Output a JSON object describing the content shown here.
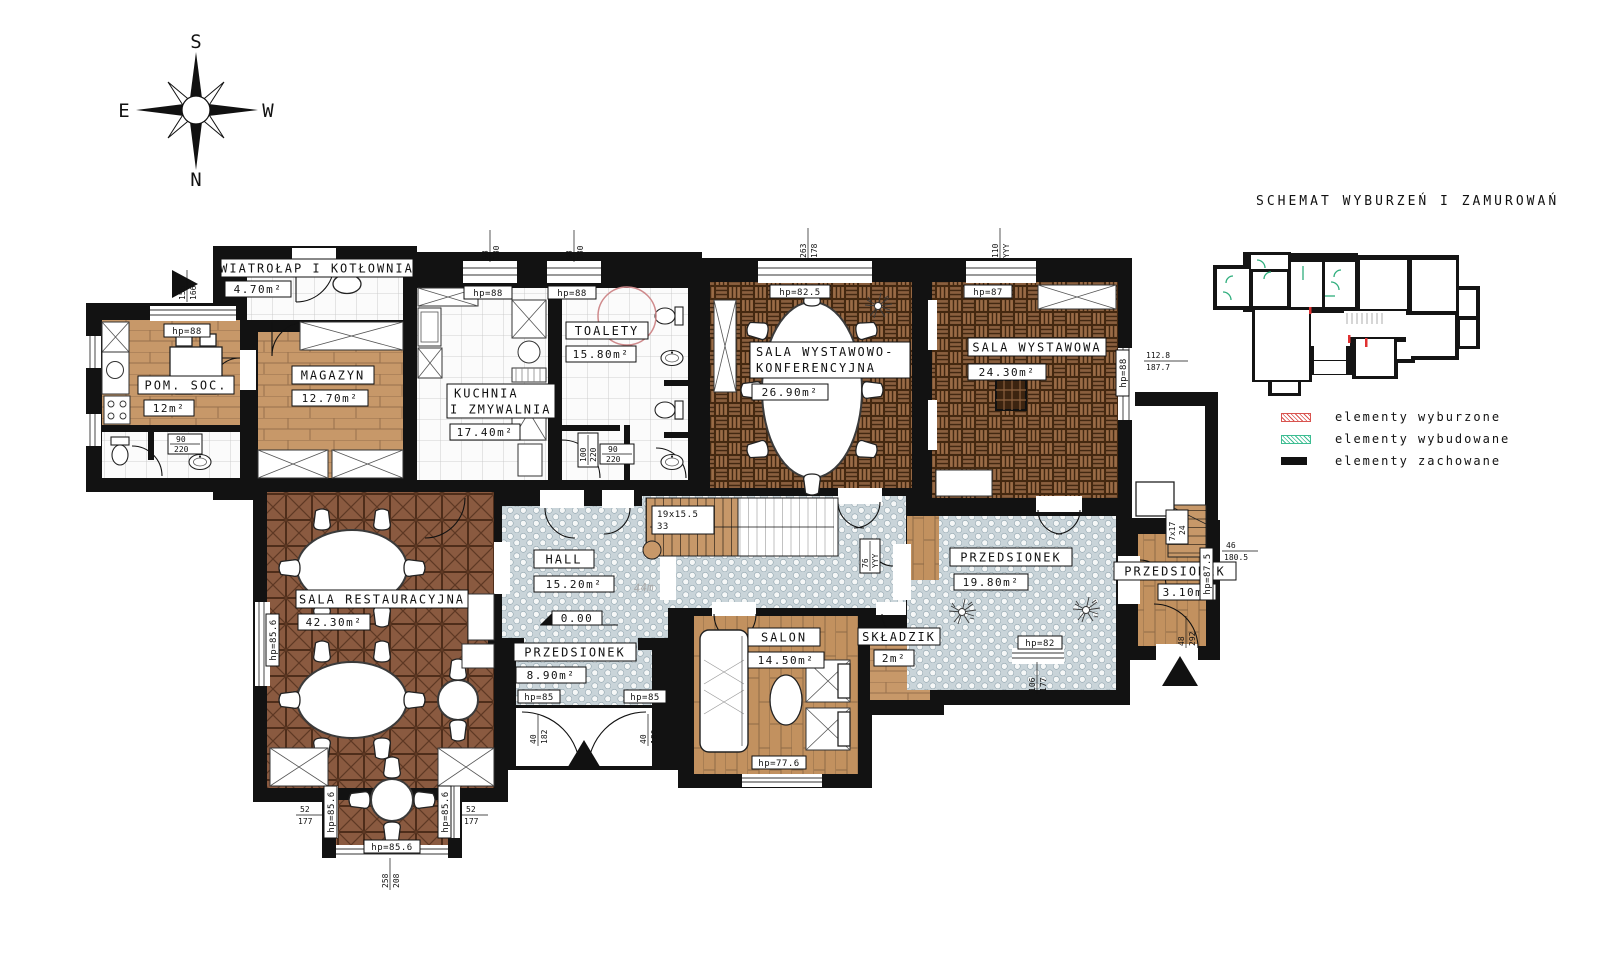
{
  "title": "SCHEMAT WYBURZEŃ I ZAMUROWAŃ",
  "compass": {
    "top": "S",
    "bottom": "N",
    "left": "E",
    "right": "W"
  },
  "legend": [
    {
      "label": "elementy wyburzone",
      "color": "#d9534f",
      "style": "red-hatch"
    },
    {
      "label": "elementy wybudowane",
      "color": "#3dbd92",
      "style": "green-hatch"
    },
    {
      "label": "elementy zachowane",
      "color": "#111111",
      "style": "solid"
    }
  ],
  "colors": {
    "wall": "#121212",
    "wood": "#c79869",
    "parquet_dark": "#8a5a40",
    "mosaic": "#c9d4d9",
    "demolished": "#e03131",
    "built": "#2fae7d"
  },
  "rooms": [
    {
      "line1": "WIATROŁAP I KOTŁOWNIA",
      "area": "4.70m²"
    },
    {
      "line1": "POM. SOC.",
      "area": "12m²"
    },
    {
      "line1": "MAGAZYN",
      "area": "12.70m²"
    },
    {
      "line1": "KUCHNIA",
      "line2": "I ZMYWALNIA",
      "area": "17.40m²"
    },
    {
      "line1": "TOALETY",
      "area": "15.80m²"
    },
    {
      "line1": "SALA WYSTAWOWO-",
      "line2": "KONFERENCYJNA",
      "area": "26.90m²"
    },
    {
      "line1": "SALA WYSTAWOWA",
      "area": "24.30m²"
    },
    {
      "line1": "SALA RESTAURACYJNA",
      "area": "42.30m²"
    },
    {
      "line1": "HALL",
      "area": "15.20m²"
    },
    {
      "line1": "PRZEDSIONEK",
      "area": "8.90m²"
    },
    {
      "line1": "SALON",
      "area": "14.50m²"
    },
    {
      "line1": "SKŁADZIK",
      "area": "2m²"
    },
    {
      "line1": "PRZEDSIONEK",
      "area": "19.80m²"
    },
    {
      "line1": "PRZEDSIONEK",
      "area": "3.10m²"
    }
  ],
  "hp": [
    "hp=88",
    "hp=88",
    "hp=88",
    "hp=82.5",
    "hp=87",
    "hp=88",
    "hp=85.6",
    "hp=85.6",
    "hp=85.6",
    "hp=85.6",
    "hp=85",
    "hp=85",
    "hp=77.6",
    "hp=82",
    "hp=87.5"
  ],
  "dims": [
    {
      "a": "98",
      "b": "180"
    },
    {
      "a": "98",
      "b": "180"
    },
    {
      "a": "263",
      "b": "178"
    },
    {
      "a": "110",
      "b": "YYY"
    },
    {
      "a": "156",
      "b": "166"
    },
    {
      "a": "112.8",
      "b": "187.7"
    },
    {
      "a": "46",
      "b": "180.5"
    },
    {
      "a": "106",
      "b": "177"
    },
    {
      "a": "52",
      "b": "177"
    },
    {
      "a": "52",
      "b": "177"
    },
    {
      "a": "258",
      "b": "208"
    },
    {
      "a": "90",
      "b": "220"
    },
    {
      "a": "90",
      "b": "220"
    },
    {
      "a": "100",
      "b": "220"
    },
    {
      "a": "40",
      "b": "182"
    },
    {
      "a": "40",
      "b": "180"
    },
    {
      "a": "48",
      "b": "292"
    },
    {
      "a": "76",
      "b": "YYY"
    }
  ],
  "stairs": [
    {
      "a": "19x15.5",
      "b": "33"
    },
    {
      "a": "7x17",
      "b": "24"
    }
  ],
  "level": "0.00",
  "note": "44m"
}
